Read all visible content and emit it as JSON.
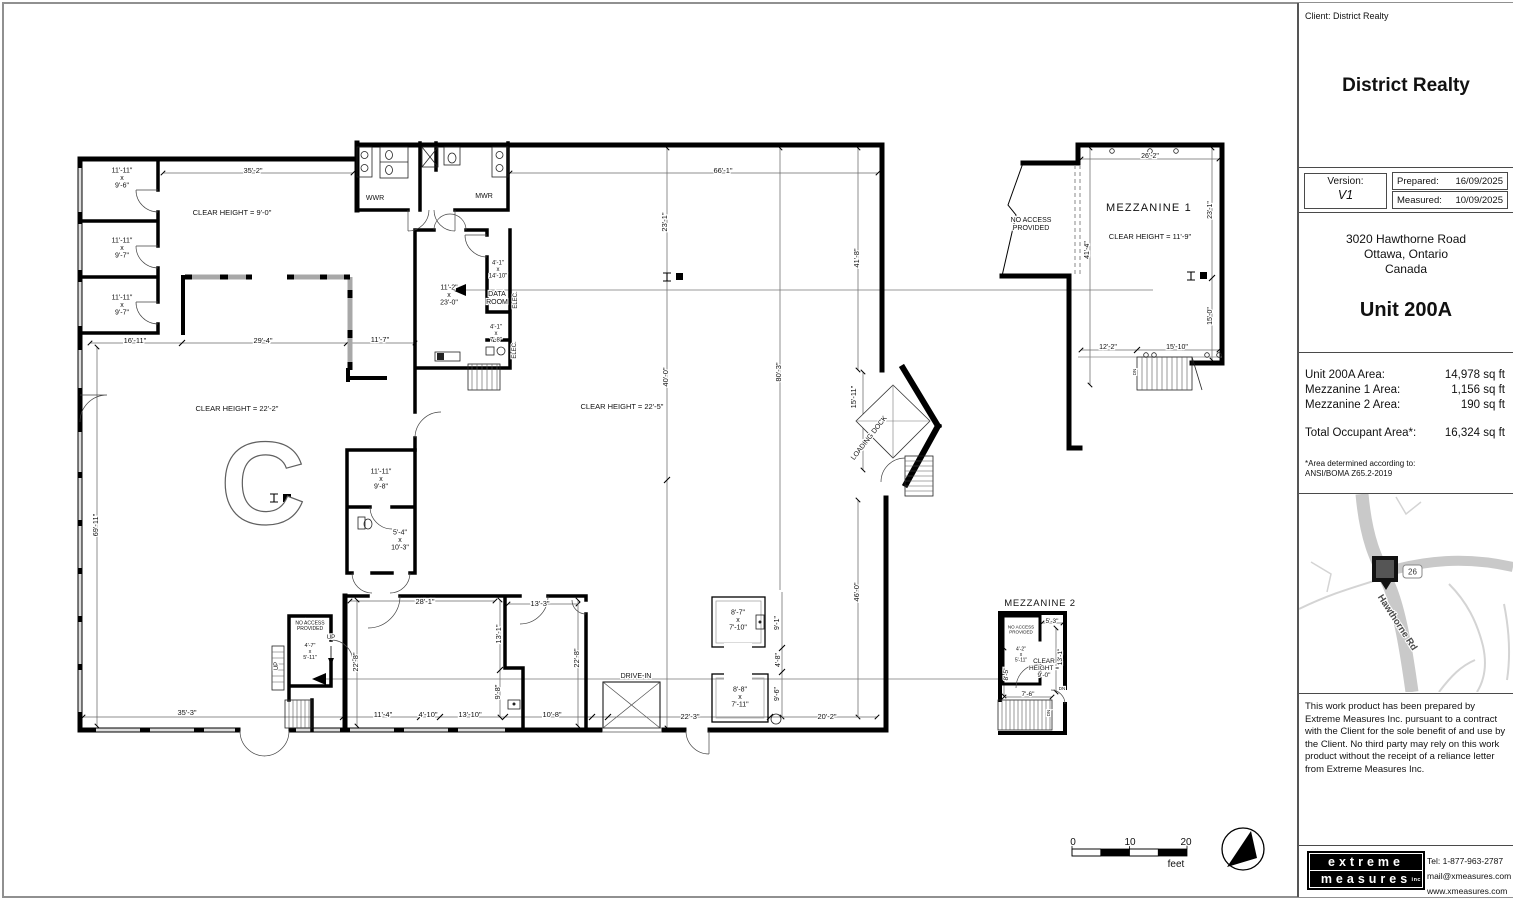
{
  "title_block": {
    "client_line": "Client: District Realty",
    "company_name": "District Realty",
    "version_label": "Version:",
    "version_value": "V1",
    "prepared_label": "Prepared:",
    "prepared_date": "16/09/2025",
    "measured_label": "Measured:",
    "measured_date": "10/09/2025",
    "address_line1": "3020 Hawthorne Road",
    "address_line2": "Ottawa, Ontario",
    "address_line3": "Canada",
    "unit_title": "Unit 200A",
    "areas": {
      "rows": [
        {
          "label": "Unit 200A Area:",
          "value": "14,978 sq ft"
        },
        {
          "label": "Mezzanine 1 Area:",
          "value": "1,156 sq ft"
        },
        {
          "label": "Mezzanine 2 Area:",
          "value": "190 sq ft"
        }
      ],
      "total_label": "Total Occupant Area*:",
      "total_value": "16,324 sq ft",
      "footnote_line1": "*Area determined according to:",
      "footnote_line2": "ANSI/BOMA Z65.2-2019"
    },
    "map": {
      "road_label": "Hawthorne Rd",
      "route_badge": "26"
    },
    "disclaimer": "This work product has been prepared by Extreme Measures Inc. pursuant to a contract with the Client for the sole benefit of and use by the Client. No third party may rely on this work product without the receipt of a reliance letter from Extreme Measures Inc.",
    "logo_line1": "extreme",
    "logo_line2": "measures",
    "logo_suffix": "inc",
    "tel_label": "Tel:",
    "tel_value": "1-877-963-2787",
    "email": "mail@xmeasures.com",
    "website": "www.xmeasures.com"
  },
  "plan": {
    "labels": [
      {
        "t": "11'-11\"\nx\n9'-6\"",
        "x": 122,
        "y": 178,
        "s": 7,
        "n": "room-size-label"
      },
      {
        "t": "11'-11\"\nx\n9'-7\"",
        "x": 122,
        "y": 248,
        "s": 7,
        "n": "room-size-label"
      },
      {
        "t": "11'-11\"\nx\n9'-7\"",
        "x": 122,
        "y": 305,
        "s": 7,
        "n": "room-size-label"
      },
      {
        "t": "CLEAR HEIGHT = 9'-0\"",
        "x": 232,
        "y": 212,
        "s": 7.5,
        "n": "clear-height-label"
      },
      {
        "t": "35'-2\"",
        "x": 253,
        "y": 170,
        "s": 7.5,
        "n": "dim-label"
      },
      {
        "t": "66'-1\"",
        "x": 723,
        "y": 170,
        "s": 7.5,
        "n": "dim-label"
      },
      {
        "t": "WWR",
        "x": 375,
        "y": 198,
        "s": 7,
        "n": "room-name-label"
      },
      {
        "t": "MWR",
        "x": 484,
        "y": 196,
        "s": 7,
        "n": "room-name-label"
      },
      {
        "t": "23'-1\"",
        "x": 664,
        "y": 222,
        "s": 7.5,
        "r": -90,
        "n": "dim-label"
      },
      {
        "t": "41'-8\"",
        "x": 856,
        "y": 258,
        "s": 7.5,
        "r": -90,
        "n": "dim-label"
      },
      {
        "t": "11'-2\"\nx\n23'-0\"",
        "x": 449,
        "y": 295,
        "s": 7,
        "n": "room-size-label"
      },
      {
        "t": "4'-1\"\nx\n14'-10\"",
        "x": 498,
        "y": 270,
        "s": 6,
        "n": "room-size-label"
      },
      {
        "t": "DATA\nROOM",
        "x": 497,
        "y": 298,
        "s": 7,
        "n": "room-name-label"
      },
      {
        "t": "ELEC.",
        "x": 516,
        "y": 300,
        "s": 6,
        "r": -90,
        "n": "room-name-label"
      },
      {
        "t": "4'-1\"\nx\n7'-8\"",
        "x": 496,
        "y": 334,
        "s": 6,
        "n": "room-size-label"
      },
      {
        "t": "ELEC.",
        "x": 515,
        "y": 350,
        "s": 6,
        "r": -90,
        "n": "room-name-label"
      },
      {
        "t": "16'-11\"",
        "x": 135,
        "y": 340,
        "s": 7.5,
        "n": "dim-label"
      },
      {
        "t": "29'-4\"",
        "x": 263,
        "y": 340,
        "s": 7.5,
        "n": "dim-label"
      },
      {
        "t": "11'-7\"",
        "x": 380,
        "y": 339,
        "s": 7.5,
        "n": "dim-label"
      },
      {
        "t": "CLEAR HEIGHT = 22'-2\"",
        "x": 237,
        "y": 408,
        "s": 7.5,
        "n": "clear-height-label"
      },
      {
        "t": "CLEAR HEIGHT = 22'-5\"",
        "x": 622,
        "y": 406,
        "s": 7.5,
        "n": "clear-height-label"
      },
      {
        "t": "C",
        "x": 263,
        "y": 484,
        "s": 118,
        "o": true,
        "n": "column-grid-letter"
      },
      {
        "t": "69'-11\"",
        "x": 95,
        "y": 525,
        "s": 7.5,
        "r": -90,
        "n": "dim-label"
      },
      {
        "t": "11'-11\"\nx\n9'-8\"",
        "x": 381,
        "y": 479,
        "s": 7,
        "n": "room-size-label"
      },
      {
        "t": "5'-4\"\nx\n10'-3\"",
        "x": 400,
        "y": 540,
        "s": 7,
        "n": "room-size-label"
      },
      {
        "t": "40'-0\"",
        "x": 665,
        "y": 377,
        "s": 7.5,
        "r": -90,
        "n": "dim-label"
      },
      {
        "t": "80'-3\"",
        "x": 778,
        "y": 372,
        "s": 7.5,
        "r": -90,
        "n": "dim-label"
      },
      {
        "t": "15'-11\"",
        "x": 853,
        "y": 397,
        "s": 7.5,
        "r": -90,
        "n": "dim-label"
      },
      {
        "t": "LOADING DOCK",
        "x": 869,
        "y": 438,
        "s": 7,
        "r": -52,
        "n": "loading-dock-label"
      },
      {
        "t": "46'-0\"",
        "x": 856,
        "y": 592,
        "s": 7.5,
        "r": -90,
        "n": "dim-label"
      },
      {
        "t": "28'-1\"",
        "x": 425,
        "y": 601,
        "s": 7.5,
        "n": "dim-label"
      },
      {
        "t": "13'-3\"",
        "x": 540,
        "y": 603,
        "s": 7.5,
        "n": "dim-label"
      },
      {
        "t": "13'-1\"",
        "x": 498,
        "y": 634,
        "s": 7.5,
        "r": -90,
        "n": "dim-label"
      },
      {
        "t": "22'-8\"",
        "x": 355,
        "y": 662,
        "s": 7.5,
        "r": -90,
        "n": "dim-label"
      },
      {
        "t": "22'-8\"",
        "x": 576,
        "y": 658,
        "s": 7.5,
        "r": -90,
        "n": "dim-label"
      },
      {
        "t": "9'-8\"",
        "x": 497,
        "y": 692,
        "s": 7.5,
        "r": -90,
        "n": "dim-label"
      },
      {
        "t": "NO ACCESS\nPROVIDED",
        "x": 310,
        "y": 626,
        "s": 5,
        "n": "no-access-label"
      },
      {
        "t": "4'-7\"\nx\n5'-11\"",
        "x": 310,
        "y": 652,
        "s": 5.5,
        "n": "room-size-label"
      },
      {
        "t": "UP",
        "x": 331,
        "y": 638,
        "s": 6,
        "n": "stair-direction-label"
      },
      {
        "t": "UP",
        "x": 277,
        "y": 666,
        "s": 6,
        "r": -90,
        "n": "stair-direction-label"
      },
      {
        "t": "DRIVE-IN",
        "x": 636,
        "y": 676,
        "s": 7,
        "n": "drive-in-label"
      },
      {
        "t": "8'-7\"\nx\n7'-10\"",
        "x": 738,
        "y": 620,
        "s": 7,
        "n": "room-size-label"
      },
      {
        "t": "8'-8\"\nx\n7'-11\"",
        "x": 740,
        "y": 697,
        "s": 7,
        "n": "room-size-label"
      },
      {
        "t": "9'-1\"",
        "x": 777,
        "y": 623,
        "s": 7,
        "r": -90,
        "n": "dim-label"
      },
      {
        "t": "4'-8\"",
        "x": 778,
        "y": 660,
        "s": 7,
        "r": -90,
        "n": "dim-label"
      },
      {
        "t": "9'-6\"",
        "x": 777,
        "y": 694,
        "s": 7,
        "r": -90,
        "n": "dim-label"
      },
      {
        "t": "35'-3\"",
        "x": 187,
        "y": 712,
        "s": 7.5,
        "n": "dim-label"
      },
      {
        "t": "11'-4\"",
        "x": 383,
        "y": 714,
        "s": 7.5,
        "n": "dim-label"
      },
      {
        "t": "4'-10\"",
        "x": 428,
        "y": 714,
        "s": 7.5,
        "n": "dim-label"
      },
      {
        "t": "13'-10\"",
        "x": 470,
        "y": 714,
        "s": 7.5,
        "n": "dim-label"
      },
      {
        "t": "10'-8\"",
        "x": 552,
        "y": 714,
        "s": 7.5,
        "n": "dim-label"
      },
      {
        "t": "22'-3\"",
        "x": 690,
        "y": 716,
        "s": 7.5,
        "n": "dim-label"
      },
      {
        "t": "20'-2\"",
        "x": 827,
        "y": 716,
        "s": 7.5,
        "n": "dim-label"
      },
      {
        "t": "MEZZANINE 1",
        "x": 1149,
        "y": 208,
        "s": 11,
        "ls": 1.2,
        "n": "mezzanine-title"
      },
      {
        "t": "CLEAR HEIGHT = 11'-9\"",
        "x": 1150,
        "y": 236,
        "s": 7.5,
        "n": "clear-height-label"
      },
      {
        "t": "NO ACCESS\nPROVIDED",
        "x": 1031,
        "y": 224,
        "s": 7,
        "n": "no-access-label"
      },
      {
        "t": "26'-2\"",
        "x": 1150,
        "y": 156,
        "s": 7,
        "n": "dim-label"
      },
      {
        "t": "23'-1\"",
        "x": 1210,
        "y": 210,
        "s": 7,
        "r": -90,
        "n": "dim-label"
      },
      {
        "t": "41'-4\"",
        "x": 1087,
        "y": 250,
        "s": 7,
        "r": -90,
        "n": "dim-label"
      },
      {
        "t": "15'-0\"",
        "x": 1210,
        "y": 316,
        "s": 7,
        "r": -90,
        "n": "dim-label"
      },
      {
        "t": "12'-2\"",
        "x": 1108,
        "y": 347,
        "s": 7,
        "n": "dim-label"
      },
      {
        "t": "15'-10\"",
        "x": 1177,
        "y": 347,
        "s": 7,
        "n": "dim-label"
      },
      {
        "t": "DN",
        "x": 1134,
        "y": 372,
        "s": 4.5,
        "r": -90,
        "n": "stair-direction-label"
      },
      {
        "t": "MEZZANINE 2",
        "x": 1040,
        "y": 603,
        "s": 9.5,
        "ls": 0.8,
        "n": "mezzanine-title"
      },
      {
        "t": "NO ACCESS\nPROVIDED",
        "x": 1021,
        "y": 629,
        "s": 4.5,
        "n": "no-access-label"
      },
      {
        "t": "4'-2\"\nx\n5'-11\"",
        "x": 1021,
        "y": 655,
        "s": 5,
        "n": "room-size-label"
      },
      {
        "t": "5'-3\"",
        "x": 1052,
        "y": 621,
        "s": 6.5,
        "n": "dim-label"
      },
      {
        "t": "13'-1\"",
        "x": 1060,
        "y": 657,
        "s": 6.5,
        "r": -90,
        "n": "dim-label"
      },
      {
        "t": "8'-5\"",
        "x": 1006,
        "y": 674,
        "s": 6.5,
        "r": -90,
        "n": "dim-label"
      },
      {
        "t": "CLEAR\nHEIGHT =\n9'-0\"",
        "x": 1044,
        "y": 668,
        "s": 6.5,
        "n": "clear-height-label"
      },
      {
        "t": "7'-6\"",
        "x": 1028,
        "y": 694,
        "s": 6.5,
        "n": "dim-label"
      },
      {
        "t": "DN",
        "x": 1062,
        "y": 688,
        "s": 4.5,
        "n": "stair-direction-label"
      },
      {
        "t": "DN",
        "x": 1048,
        "y": 713,
        "s": 4.5,
        "r": -90,
        "n": "stair-direction-label"
      },
      {
        "t": "0",
        "x": 1073,
        "y": 842,
        "s": 10,
        "n": "scale-tick-label"
      },
      {
        "t": "10",
        "x": 1130,
        "y": 842,
        "s": 10,
        "n": "scale-tick-label"
      },
      {
        "t": "20",
        "x": 1186,
        "y": 842,
        "s": 10,
        "n": "scale-tick-label"
      },
      {
        "t": "feet",
        "x": 1176,
        "y": 864,
        "s": 10,
        "n": "scale-unit-label"
      }
    ]
  }
}
